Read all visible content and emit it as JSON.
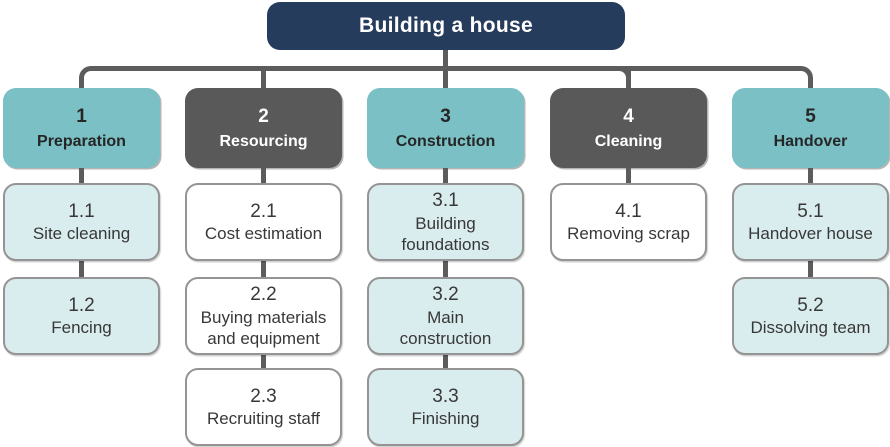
{
  "title": {
    "label": "Building a house"
  },
  "colors": {
    "root_bg": "#263c5c",
    "teal_header": "#7ac0c4",
    "gray_header": "#595959",
    "teal_sub": "#d9ecee",
    "white_sub": "#ffffff",
    "sub_border": "#949494",
    "connector": "#5c5c5c"
  },
  "columns": [
    {
      "number": "1",
      "name": "Preparation",
      "style": "teal",
      "children": [
        {
          "code": "1.1",
          "label": "Site cleaning"
        },
        {
          "code": "1.2",
          "label": "Fencing"
        }
      ]
    },
    {
      "number": "2",
      "name": "Resourcing",
      "style": "gray",
      "children": [
        {
          "code": "2.1",
          "label": "Cost estimation"
        },
        {
          "code": "2.2",
          "label": "Buying materials\nand equipment"
        },
        {
          "code": "2.3",
          "label": "Recruiting staff"
        }
      ]
    },
    {
      "number": "3",
      "name": "Construction",
      "style": "teal",
      "children": [
        {
          "code": "3.1",
          "label": "Building\nfoundations"
        },
        {
          "code": "3.2",
          "label": "Main\nconstruction"
        },
        {
          "code": "3.3",
          "label": "Finishing"
        }
      ]
    },
    {
      "number": "4",
      "name": "Cleaning",
      "style": "gray",
      "children": [
        {
          "code": "4.1",
          "label": "Removing scrap"
        }
      ]
    },
    {
      "number": "5",
      "name": "Handover",
      "style": "teal",
      "children": [
        {
          "code": "5.1",
          "label": "Handover house"
        },
        {
          "code": "5.2",
          "label": "Dissolving team"
        }
      ]
    }
  ]
}
